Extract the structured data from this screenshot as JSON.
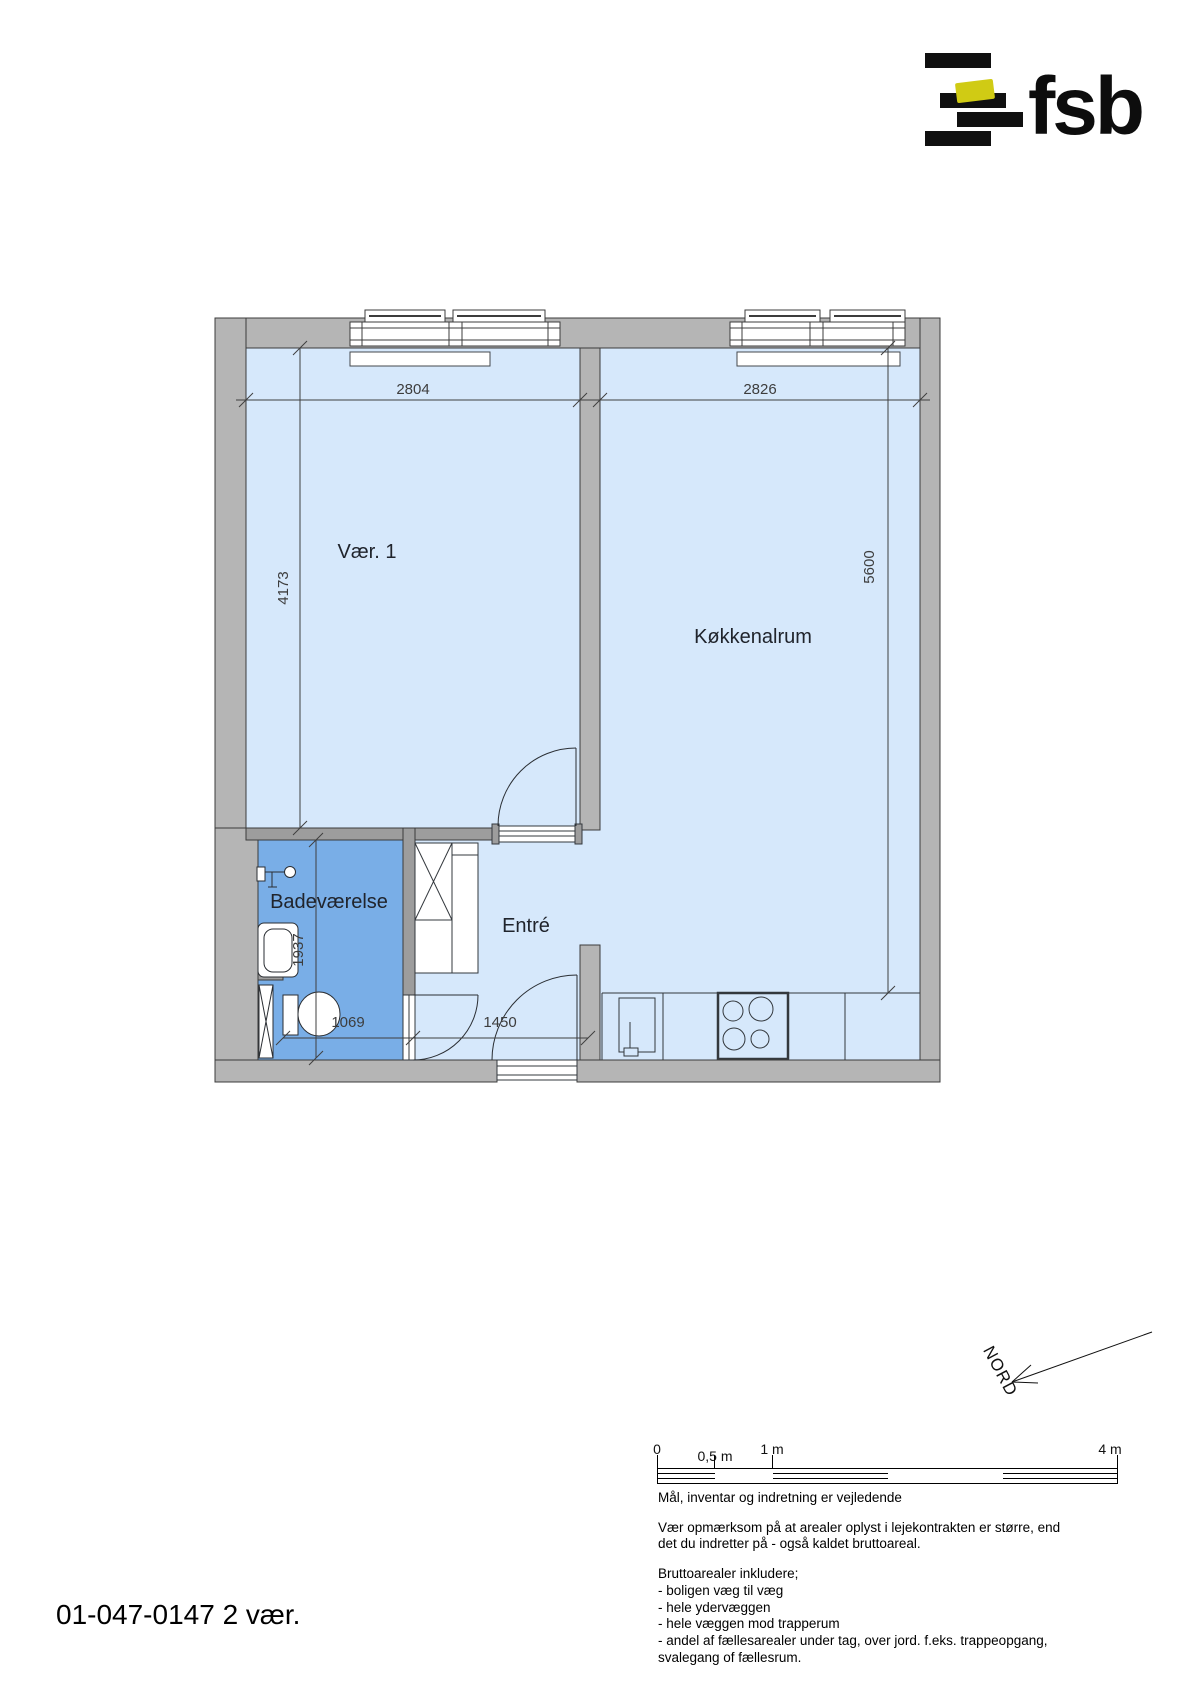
{
  "logo": {
    "text": "fsb",
    "accent_color": "#d0cb14",
    "bar_color": "#101010"
  },
  "plan": {
    "labels": {
      "room1": "Vær. 1",
      "room2": "Køkkenalrum",
      "bath": "Badeværelse",
      "entry": "Entré"
    },
    "dims": {
      "room1_width": "2804",
      "room2_width": "2826",
      "room1_height": "4173",
      "room2_height": "5600",
      "bath_height": "1937",
      "bath_width": "1069",
      "entry_width": "1450"
    },
    "colors": {
      "room_fill": "#d6e8fb",
      "bath_fill": "#79aee7",
      "wall_fill": "#b5b5b5",
      "line": "#3c3c3c"
    }
  },
  "north": {
    "label": "NORD"
  },
  "scalebar": {
    "labels": [
      "0",
      "0,5 m",
      "1 m",
      "4 m"
    ]
  },
  "notes": {
    "p1": "Mål, inventar og indretning er vejledende",
    "p2a": "Vær opmærksom på at arealer oplyst i lejekontrakten er større, end",
    "p2b": "det du indretter på - også kaldet bruttoareal.",
    "p3a": "Bruttoarealer inkludere;",
    "p3b": "- boligen væg til væg",
    "p3c": "- hele ydervæggen",
    "p3d": "- hele væggen mod trapperum",
    "p3e": "- andel af fællesarealer under tag, over jord. f.eks. trappeopgang,",
    "p3f": "svalegang of fællesrum."
  },
  "footer": {
    "id": "01-047-0147 2 vær."
  }
}
